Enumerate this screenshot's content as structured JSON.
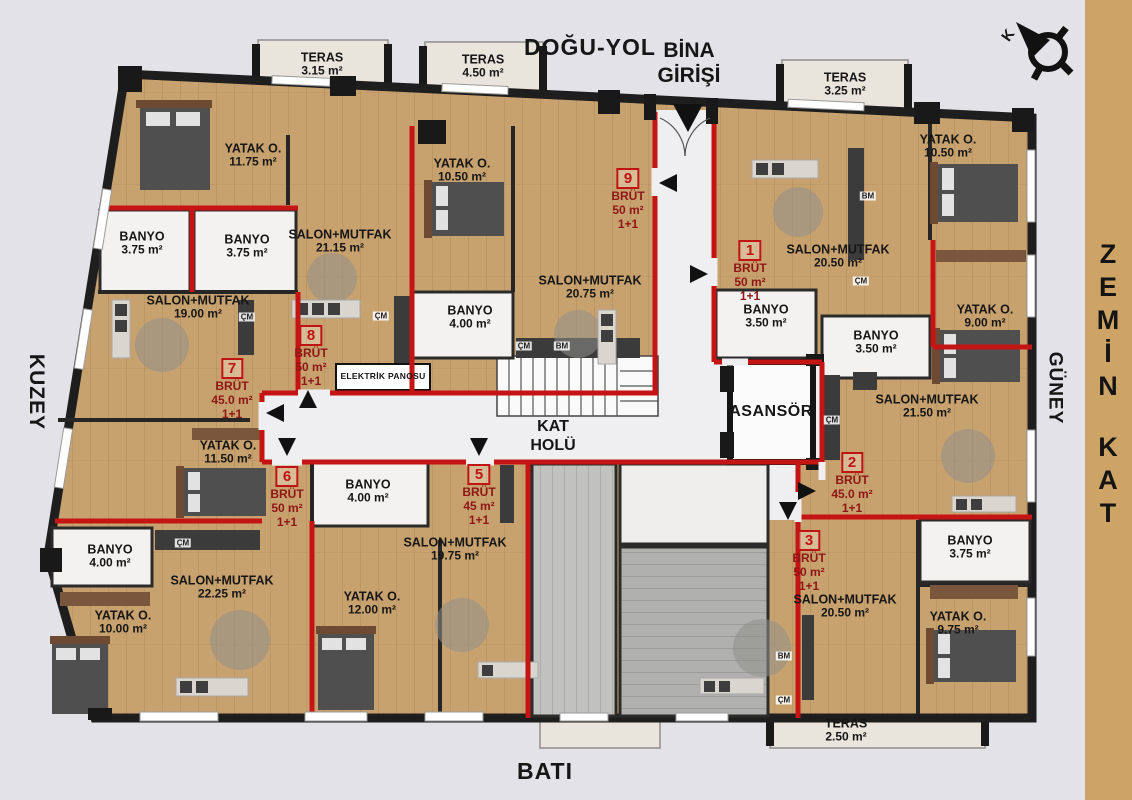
{
  "title_labels": {
    "road_top": "DOĞU-YOL",
    "entrance_line1": "BİNA",
    "entrance_line2": "GİRİŞİ",
    "west": "BATI",
    "north": "KUZEY",
    "south": "GÜNEY",
    "floor_title": "ZEMİN KAT",
    "compass_north": "K",
    "hall_line1": "KAT",
    "hall_line2": "HOLÜ",
    "elevator": "ASANSÖR",
    "electric_panel": "ELEKTRİK PANOSU"
  },
  "colors": {
    "background": "#e3e2e6",
    "sidebar": "#cda465",
    "wood_floor": "#c8a26e",
    "unit_boundary_red": "#c41414",
    "wall_black": "#1e1e1e"
  },
  "rooms": [
    {
      "name": "TERAS",
      "area": "3.15 m²",
      "x": 322,
      "y": 64
    },
    {
      "name": "TERAS",
      "area": "4.50 m²",
      "x": 483,
      "y": 66
    },
    {
      "name": "TERAS",
      "area": "3.25 m²",
      "x": 845,
      "y": 84
    },
    {
      "name": "TERAS",
      "area": "2.50 m²",
      "x": 846,
      "y": 730
    },
    {
      "name": "YATAK O.",
      "area": "11.75 m²",
      "x": 253,
      "y": 155
    },
    {
      "name": "YATAK O.",
      "area": "10.50 m²",
      "x": 462,
      "y": 170
    },
    {
      "name": "YATAK O.",
      "area": "10.50 m²",
      "x": 948,
      "y": 146
    },
    {
      "name": "BANYO",
      "area": "3.75 m²",
      "x": 142,
      "y": 243
    },
    {
      "name": "BANYO",
      "area": "3.75 m²",
      "x": 247,
      "y": 246
    },
    {
      "name": "SALON+MUTFAK",
      "area": "21.15 m²",
      "x": 340,
      "y": 241
    },
    {
      "name": "SALON+MUTFAK",
      "area": "19.00 m²",
      "x": 198,
      "y": 307
    },
    {
      "name": "SALON+MUTFAK",
      "area": "20.75 m²",
      "x": 590,
      "y": 287
    },
    {
      "name": "BANYO",
      "area": "4.00 m²",
      "x": 470,
      "y": 317
    },
    {
      "name": "SALON+MUTFAK",
      "area": "20.50 m²",
      "x": 838,
      "y": 256
    },
    {
      "name": "BANYO",
      "area": "3.50 m²",
      "x": 766,
      "y": 316
    },
    {
      "name": "BANYO",
      "area": "3.50 m²",
      "x": 876,
      "y": 342
    },
    {
      "name": "YATAK O.",
      "area": "9.00 m²",
      "x": 985,
      "y": 316
    },
    {
      "name": "SALON+MUTFAK",
      "area": "21.50 m²",
      "x": 927,
      "y": 406
    },
    {
      "name": "YATAK O.",
      "area": "11.50 m²",
      "x": 228,
      "y": 452
    },
    {
      "name": "BANYO",
      "area": "4.00 m²",
      "x": 110,
      "y": 556
    },
    {
      "name": "YATAK O.",
      "area": "10.00 m²",
      "x": 123,
      "y": 622
    },
    {
      "name": "SALON+MUTFAK",
      "area": "22.25 m²",
      "x": 222,
      "y": 587
    },
    {
      "name": "BANYO",
      "area": "4.00 m²",
      "x": 368,
      "y": 491
    },
    {
      "name": "YATAK O.",
      "area": "12.00 m²",
      "x": 372,
      "y": 603
    },
    {
      "name": "SALON+MUTFAK",
      "area": "19.75 m²",
      "x": 455,
      "y": 549
    },
    {
      "name": "SALON+MUTFAK",
      "area": "20.50 m²",
      "x": 845,
      "y": 606
    },
    {
      "name": "BANYO",
      "area": "3.75 m²",
      "x": 970,
      "y": 547
    },
    {
      "name": "YATAK O.",
      "area": "9.75 m²",
      "x": 958,
      "y": 623
    }
  ],
  "units": [
    {
      "no": "9",
      "brut": "BRÜT",
      "area": "50 m²",
      "plan": "1+1",
      "x": 628,
      "y": 168
    },
    {
      "no": "1",
      "brut": "BRÜT",
      "area": "50 m²",
      "plan": "1+1",
      "x": 750,
      "y": 240
    },
    {
      "no": "8",
      "brut": "BRÜT",
      "area": "50 m²",
      "plan": "1+1",
      "x": 311,
      "y": 325
    },
    {
      "no": "7",
      "brut": "BRÜT",
      "area": "45.0 m²",
      "plan": "1+1",
      "x": 232,
      "y": 358
    },
    {
      "no": "6",
      "brut": "BRÜT",
      "area": "50 m²",
      "plan": "1+1",
      "x": 287,
      "y": 466
    },
    {
      "no": "5",
      "brut": "BRÜT",
      "area": "45 m²",
      "plan": "1+1",
      "x": 479,
      "y": 464
    },
    {
      "no": "2",
      "brut": "BRÜT",
      "area": "45.0 m²",
      "plan": "1+1",
      "x": 852,
      "y": 452
    },
    {
      "no": "3",
      "brut": "BRÜT",
      "area": "50 m²",
      "plan": "1+1",
      "x": 809,
      "y": 530
    }
  ],
  "appliances": [
    {
      "label": "ÇM",
      "x": 247,
      "y": 317
    },
    {
      "label": "ÇM",
      "x": 381,
      "y": 316
    },
    {
      "label": "ÇM",
      "x": 524,
      "y": 346
    },
    {
      "label": "BM",
      "x": 562,
      "y": 346
    },
    {
      "label": "BM",
      "x": 868,
      "y": 196
    },
    {
      "label": "ÇM",
      "x": 861,
      "y": 281
    },
    {
      "label": "ÇM",
      "x": 832,
      "y": 420
    },
    {
      "label": "ÇM",
      "x": 183,
      "y": 543
    },
    {
      "label": "BM",
      "x": 784,
      "y": 656
    },
    {
      "label": "ÇM",
      "x": 784,
      "y": 700
    }
  ]
}
